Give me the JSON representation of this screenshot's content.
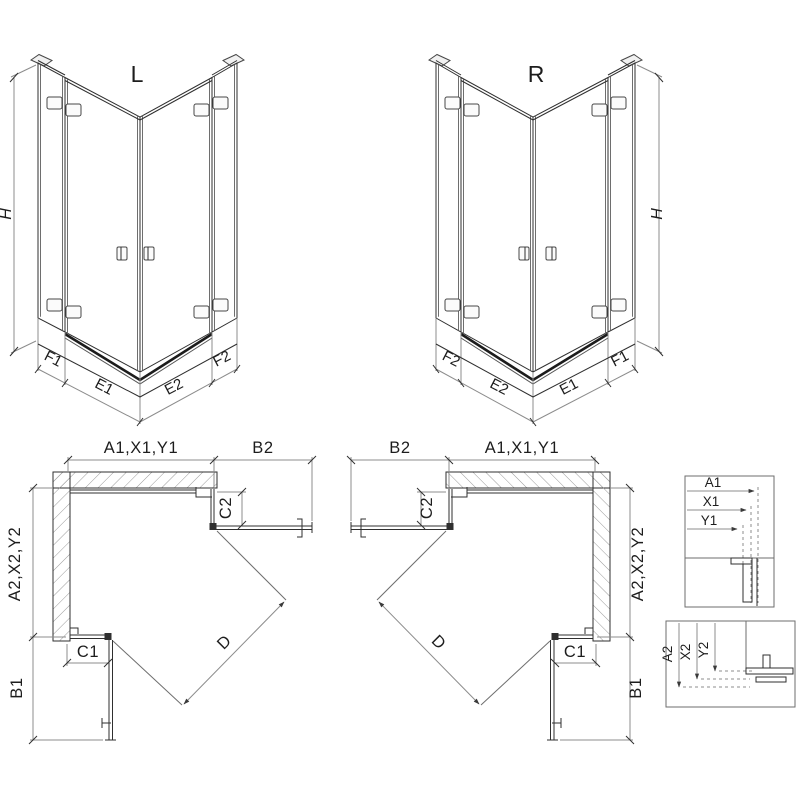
{
  "drawing": {
    "iso_left": {
      "title": "L",
      "h": "H",
      "f1": "F1",
      "e1": "E1",
      "e2": "E2",
      "f2": "F2"
    },
    "iso_right": {
      "title": "R",
      "h": "H",
      "f1": "F1",
      "e1": "E1",
      "e2": "E2",
      "f2": "F2"
    },
    "plan_left": {
      "width_top": "A1,X1,Y1",
      "return_panel": "B2",
      "depth_side": "A2,X2,Y2",
      "c2": "C2",
      "c1": "C1",
      "b1": "B1",
      "diagonal": "D"
    },
    "plan_right": {
      "width_top": "A1,X1,Y1",
      "return_panel": "B2",
      "depth_side": "A2,X2,Y2",
      "c2": "C2",
      "c1": "C1",
      "b1": "B1",
      "diagonal": "D"
    },
    "detail_top": {
      "a1": "A1",
      "x1": "X1",
      "y1": "Y1"
    },
    "detail_bottom": {
      "a2": "A2",
      "x2": "X2",
      "y2": "Y2"
    }
  },
  "colors": {
    "background": "#ffffff",
    "line": "#2f2f2f",
    "glass": "#6e6e6e",
    "dim": "#8c8c8c",
    "hatch": "#9a9a9a",
    "threshold": "#1c1c1c"
  }
}
